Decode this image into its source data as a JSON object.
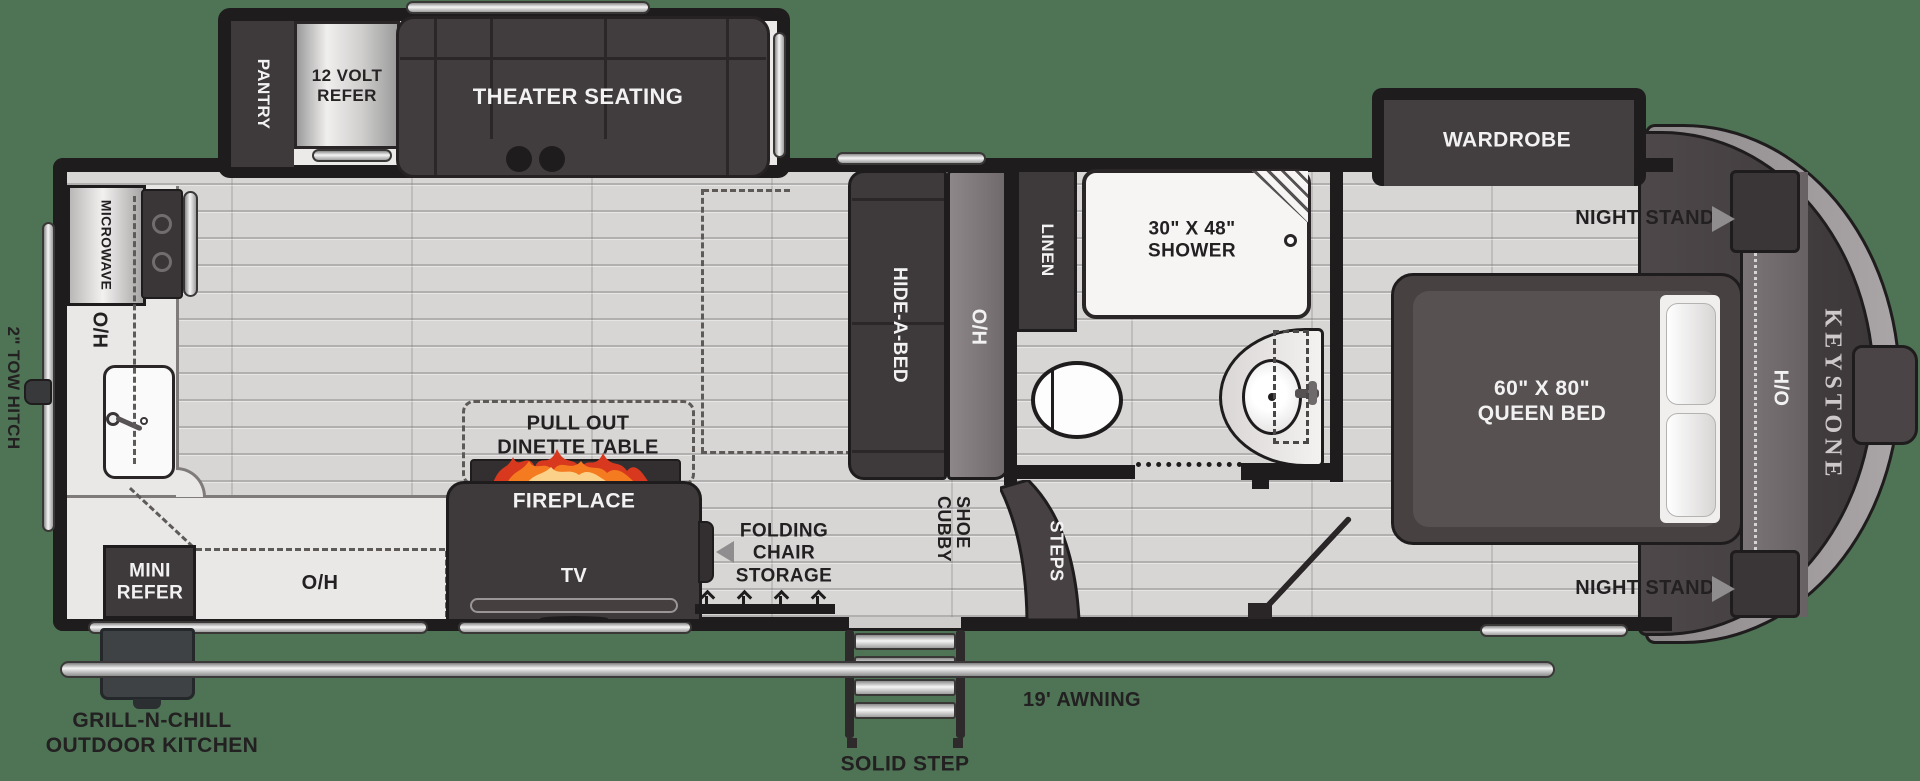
{
  "title": "Keystone fifth wheel RV floor plan",
  "brand": "KEYSTONE",
  "exterior": {
    "tow_hitch": "2\" TOW HITCH",
    "grill_line1": "GRILL-N-CHILL",
    "grill_line2": "OUTDOOR KITCHEN",
    "awning": "19' AWNING",
    "solid_step": "SOLID STEP"
  },
  "kitchen_slide": {
    "pantry": "PANTRY",
    "refer_line1": "12 VOLT",
    "refer_line2": "REFER",
    "theater_seating": "THEATER SEATING"
  },
  "kitchen": {
    "microwave": "MICROWAVE",
    "overhead_rear": "O/H",
    "mini_refer_line1": "MINI",
    "mini_refer_line2": "REFER",
    "overhead_bottom": "O/H",
    "dinette_line1": "PULL OUT",
    "dinette_line2": "DINETTE TABLE"
  },
  "living": {
    "fireplace": "FIREPLACE",
    "tv": "TV",
    "folding_line1": "FOLDING",
    "folding_line2": "CHAIR",
    "folding_line3": "STORAGE",
    "hide_a_bed": "HIDE-A-BED",
    "overhead_sofa": "O/H"
  },
  "bathroom": {
    "linen": "LINEN",
    "shower_line1": "30\" X 48\"",
    "shower_line2": "SHOWER"
  },
  "entry": {
    "shoe_cubby": "SHOE CUBBY",
    "steps": "STEPS"
  },
  "bedroom": {
    "wardrobe": "WARDROBE",
    "night_stand_top": "NIGHT STAND",
    "night_stand_bottom": "NIGHT STAND",
    "bed_line1": "60\" X 80\"",
    "bed_line2": "QUEEN BED",
    "overhead_front": "H/O"
  },
  "colors": {
    "background": "#4e7355",
    "walls": "#1f1c1d",
    "furniture_dark": "#3e393b",
    "floor": "#d7d6d5",
    "counter": "#eae8e7",
    "flame_orange": "#f47b20"
  }
}
